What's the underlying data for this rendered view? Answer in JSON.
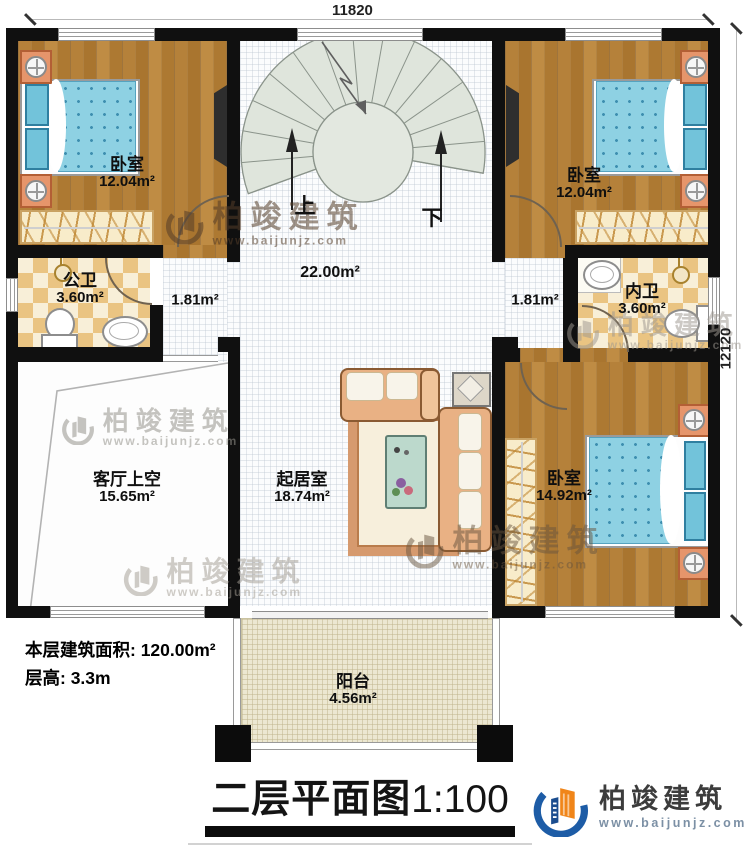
{
  "dimensions": {
    "top": "11820",
    "right": "12120"
  },
  "rooms": {
    "bedroom_tl": {
      "name": "卧室",
      "area": "12.04m²"
    },
    "bedroom_tr": {
      "name": "卧室",
      "area": "12.04m²"
    },
    "bathroom_left": {
      "name": "公卫",
      "area": "3.60m²"
    },
    "bathroom_right": {
      "name": "内卫",
      "area": "3.60m²"
    },
    "corridor_left": {
      "area": "1.81m²"
    },
    "corridor_right": {
      "area": "1.81m²"
    },
    "hall": {
      "area": "22.00m²"
    },
    "living_void": {
      "name": "客厅上空",
      "area": "15.65m²"
    },
    "living_room": {
      "name": "起居室",
      "area": "18.74m²"
    },
    "bedroom_br": {
      "name": "卧室",
      "area": "14.92m²"
    },
    "balcony": {
      "name": "阳台",
      "area": "4.56m²"
    }
  },
  "stairs": {
    "up_label": "上",
    "down_label": "下"
  },
  "info": {
    "floor_area": "本层建筑面积: 120.00m²",
    "floor_height": "层高: 3.3m"
  },
  "title": {
    "main": "二层平面图",
    "scale": "1:100"
  },
  "brand": {
    "name": "柏竣建筑",
    "url": "www.baijunjz.com"
  },
  "colors": {
    "wall": "#101010",
    "brand_blue": "#1d5ca6",
    "brand_orange": "#f08519",
    "bed_blue": "#8ed1e3",
    "checker_tan": "#eac482",
    "stair_green": "#dfe5dc"
  }
}
